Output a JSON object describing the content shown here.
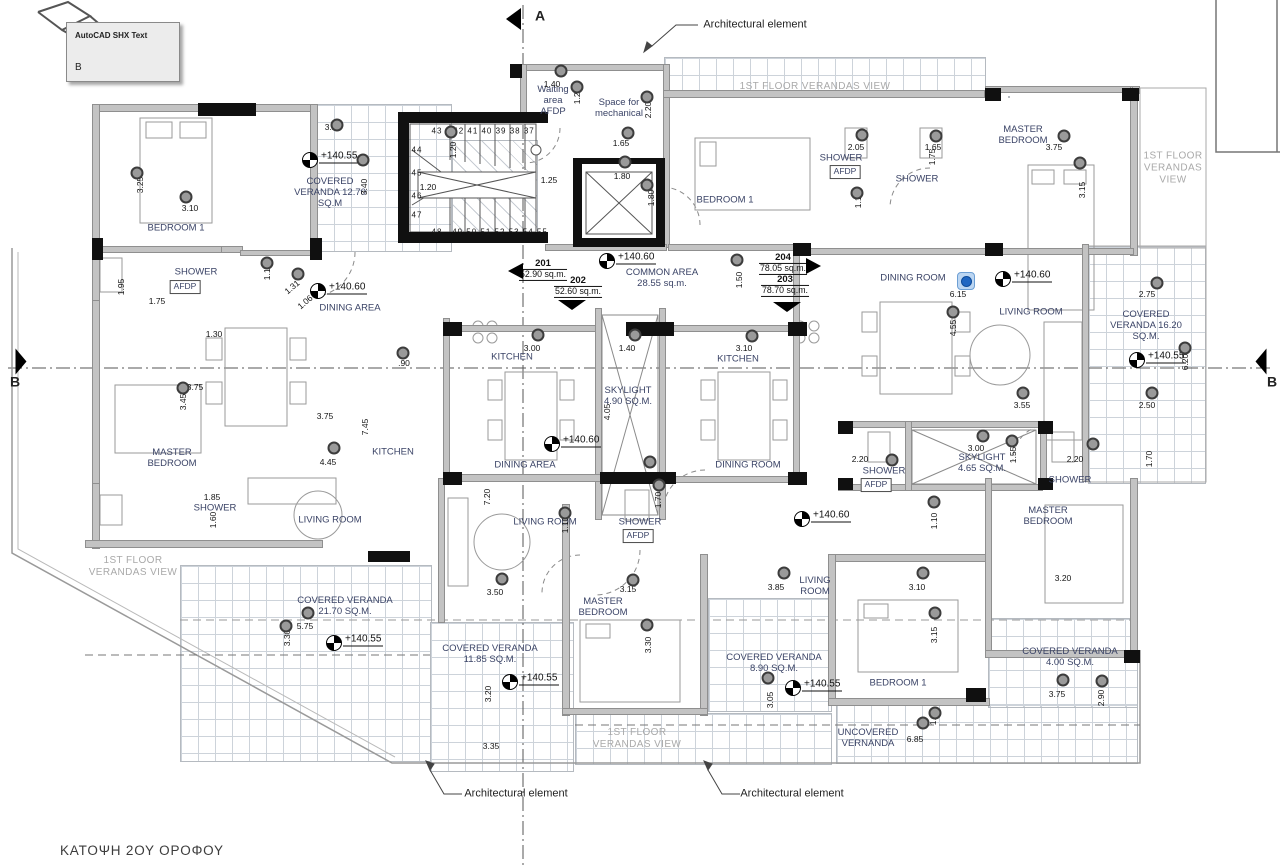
{
  "title": "ΚΑΤΟΨΗ 2ΟΥ ΟΡΟΦΟΥ",
  "tooltip": {
    "title": "AutoCAD SHX Text",
    "value": "B"
  },
  "section_markers": {
    "top": "A",
    "left": "B",
    "right": "B"
  },
  "arch_note_text": "Architectural element",
  "arch_notes": [
    {
      "x": 755,
      "y": 25
    },
    {
      "x": 516,
      "y": 794
    },
    {
      "x": 792,
      "y": 794
    }
  ],
  "units": [
    {
      "num": "201",
      "area": "52.90 sq.m.",
      "x": 543,
      "y": 270,
      "arrow": "left",
      "ax": 523,
      "ay": 271
    },
    {
      "num": "202",
      "area": "52.60 sq.m.",
      "x": 578,
      "y": 287,
      "arrow": "down",
      "ax": 572,
      "ay": 300
    },
    {
      "num": "204",
      "area": "78.05 sq.m.",
      "x": 783,
      "y": 264,
      "arrow": "right",
      "ax": 806,
      "ay": 266
    },
    {
      "num": "203",
      "area": "78.70 sq.m.",
      "x": 785,
      "y": 286,
      "arrow": "down",
      "ax": 787,
      "ay": 302
    }
  ],
  "common_area": {
    "name": "COMMON AREA",
    "area": "28.55 sq.m.",
    "x": 662,
    "y": 278
  },
  "levels": [
    {
      "v": "+140.55",
      "x": 310,
      "y": 160
    },
    {
      "v": "+140.60",
      "x": 318,
      "y": 291
    },
    {
      "v": "+140.60",
      "x": 607,
      "y": 261
    },
    {
      "v": "+140.60",
      "x": 1003,
      "y": 279
    },
    {
      "v": "+140.55",
      "x": 1137,
      "y": 360
    },
    {
      "v": "+140.60",
      "x": 552,
      "y": 444
    },
    {
      "v": "+140.60",
      "x": 802,
      "y": 519
    },
    {
      "v": "+140.55",
      "x": 334,
      "y": 643
    },
    {
      "v": "+140.55",
      "x": 510,
      "y": 682
    },
    {
      "v": "+140.55",
      "x": 793,
      "y": 688
    }
  ],
  "rooms": [
    {
      "t": "BEDROOM 1",
      "x": 176,
      "y": 228
    },
    {
      "t": "SHOWER",
      "x": 196,
      "y": 272
    },
    {
      "t": "COVERED\nVERANDA 12.70\nSQ.M",
      "x": 330,
      "y": 193
    },
    {
      "t": "DINING AREA",
      "x": 350,
      "y": 308
    },
    {
      "t": "Waiting\narea\nAFDP",
      "x": 553,
      "y": 101
    },
    {
      "t": "Space for\nmechanical",
      "x": 619,
      "y": 108
    },
    {
      "t": "BEDROOM 1",
      "x": 725,
      "y": 200
    },
    {
      "t": "SHOWER",
      "x": 841,
      "y": 158
    },
    {
      "t": "SHOWER",
      "x": 917,
      "y": 179
    },
    {
      "t": "MASTER\nBEDROOM",
      "x": 1023,
      "y": 135
    },
    {
      "t": "DINING ROOM",
      "x": 913,
      "y": 278
    },
    {
      "t": "LIVING ROOM",
      "x": 1031,
      "y": 312
    },
    {
      "t": "COVERED\nVERANDA 16.20\nSQ.M.",
      "x": 1146,
      "y": 326
    },
    {
      "t": "KITCHEN",
      "x": 512,
      "y": 357
    },
    {
      "t": "KITCHEN",
      "x": 738,
      "y": 359
    },
    {
      "t": "SKYLIGHT\n4.90 SQ.M.",
      "x": 628,
      "y": 396
    },
    {
      "t": "DINING AREA",
      "x": 525,
      "y": 465
    },
    {
      "t": "DINING ROOM",
      "x": 748,
      "y": 465
    },
    {
      "t": "MASTER\nBEDROOM",
      "x": 172,
      "y": 458
    },
    {
      "t": "KITCHEN",
      "x": 393,
      "y": 452
    },
    {
      "t": "SHOWER",
      "x": 215,
      "y": 508
    },
    {
      "t": "LIVING ROOM",
      "x": 330,
      "y": 520
    },
    {
      "t": "LIVING ROOM",
      "x": 545,
      "y": 522
    },
    {
      "t": "SHOWER",
      "x": 640,
      "y": 522
    },
    {
      "t": "SHOWER",
      "x": 884,
      "y": 471
    },
    {
      "t": "SKYLIGHT\n4.65 SQ.M.",
      "x": 982,
      "y": 463
    },
    {
      "t": "SHOWER",
      "x": 1070,
      "y": 480
    },
    {
      "t": "MASTER\nBEDROOM",
      "x": 1048,
      "y": 516
    },
    {
      "t": "MASTER\nBEDROOM",
      "x": 603,
      "y": 607
    },
    {
      "t": "COVERED VERANDA\n21.70 SQ.M.",
      "x": 345,
      "y": 606
    },
    {
      "t": "COVERED VERANDA\n11.85 SQ.M.",
      "x": 490,
      "y": 654
    },
    {
      "t": "LIVING\nROOM",
      "x": 815,
      "y": 586
    },
    {
      "t": "COVERED VERANDA\n8.90 SQ.M.",
      "x": 774,
      "y": 663
    },
    {
      "t": "BEDROOM 1",
      "x": 898,
      "y": 683
    },
    {
      "t": "UNCOVERED\nVERNANDA",
      "x": 868,
      "y": 738
    },
    {
      "t": "COVERED VERANDA\n4.00 SQ.M.",
      "x": 1070,
      "y": 657
    }
  ],
  "afdp_label": "AFDP",
  "afdp_boxes": [
    {
      "x": 845,
      "y": 172
    },
    {
      "x": 185,
      "y": 287
    },
    {
      "x": 876,
      "y": 485
    },
    {
      "x": 638,
      "y": 536
    }
  ],
  "gray_notes": [
    {
      "t": "1ST FLOOR VERANDAS VIEW",
      "x": 815,
      "y": 87
    },
    {
      "t": "1ST FLOOR\nVERANDAS\nVIEW",
      "x": 1173,
      "y": 168
    },
    {
      "t": "1ST FLOOR\nVERANDAS VIEW",
      "x": 133,
      "y": 567
    },
    {
      "t": "1ST FLOOR\nVERANDAS VIEW",
      "x": 637,
      "y": 739
    }
  ],
  "dims_h": [
    {
      "t": "1.40",
      "x": 552,
      "y": 84
    },
    {
      "t": "1.65",
      "x": 621,
      "y": 143
    },
    {
      "t": "1.25",
      "x": 549,
      "y": 180
    },
    {
      "t": "1.80",
      "x": 622,
      "y": 176
    },
    {
      "t": "1.20",
      "x": 428,
      "y": 187
    },
    {
      "t": "2.05",
      "x": 856,
      "y": 147
    },
    {
      "t": "1.65",
      "x": 933,
      "y": 147
    },
    {
      "t": "3.75",
      "x": 1054,
      "y": 147
    },
    {
      "t": "3.10",
      "x": 190,
      "y": 208
    },
    {
      "t": "1.75",
      "x": 157,
      "y": 301
    },
    {
      "t": "3.20",
      "x": 333,
      "y": 127
    },
    {
      "t": "6.15",
      "x": 958,
      "y": 294
    },
    {
      "t": "2.75",
      "x": 1147,
      "y": 294
    },
    {
      "t": "2.50",
      "x": 1147,
      "y": 405
    },
    {
      "t": "3.55",
      "x": 1022,
      "y": 405
    },
    {
      "t": "3.00",
      "x": 532,
      "y": 348
    },
    {
      "t": "1.40",
      "x": 627,
      "y": 348
    },
    {
      "t": "3.10",
      "x": 744,
      "y": 348
    },
    {
      "t": "1.30",
      "x": 214,
      "y": 334
    },
    {
      "t": ".90",
      "x": 404,
      "y": 363
    },
    {
      "t": "3.75",
      "x": 325,
      "y": 416
    },
    {
      "t": "4.45",
      "x": 328,
      "y": 462
    },
    {
      "t": "1.85",
      "x": 212,
      "y": 497
    },
    {
      "t": "3.75",
      "x": 195,
      "y": 387
    },
    {
      "t": "5.75",
      "x": 305,
      "y": 626
    },
    {
      "t": "3.50",
      "x": 495,
      "y": 592
    },
    {
      "t": "3.15",
      "x": 628,
      "y": 589
    },
    {
      "t": "3.35",
      "x": 491,
      "y": 746
    },
    {
      "t": "3.85",
      "x": 776,
      "y": 587
    },
    {
      "t": "3.10",
      "x": 917,
      "y": 587
    },
    {
      "t": "6.85",
      "x": 915,
      "y": 739
    },
    {
      "t": "3.75",
      "x": 1057,
      "y": 694
    },
    {
      "t": "3.20",
      "x": 1063,
      "y": 578
    },
    {
      "t": "2.20",
      "x": 860,
      "y": 459
    },
    {
      "t": "3.00",
      "x": 976,
      "y": 448
    },
    {
      "t": "2.20",
      "x": 1075,
      "y": 459
    }
  ],
  "dims_v": [
    {
      "t": "2.20",
      "x": 648,
      "y": 110
    },
    {
      "t": "1.20",
      "x": 577,
      "y": 96
    },
    {
      "t": "1.80",
      "x": 651,
      "y": 198
    },
    {
      "t": "1.20",
      "x": 453,
      "y": 150
    },
    {
      "t": "1.75",
      "x": 932,
      "y": 157
    },
    {
      "t": "1.10",
      "x": 858,
      "y": 200
    },
    {
      "t": "3.15",
      "x": 1082,
      "y": 190
    },
    {
      "t": "3.25",
      "x": 140,
      "y": 185
    },
    {
      "t": "3.40",
      "x": 364,
      "y": 187
    },
    {
      "t": "1.95",
      "x": 121,
      "y": 287
    },
    {
      "t": "1.10",
      "x": 267,
      "y": 272
    },
    {
      "t": "1.50",
      "x": 739,
      "y": 280
    },
    {
      "t": "4.55",
      "x": 953,
      "y": 328
    },
    {
      "t": "6.20",
      "x": 1185,
      "y": 362
    },
    {
      "t": "4.05",
      "x": 607,
      "y": 412
    },
    {
      "t": "3.45",
      "x": 183,
      "y": 402
    },
    {
      "t": "7.45",
      "x": 365,
      "y": 427
    },
    {
      "t": "1.60",
      "x": 213,
      "y": 520
    },
    {
      "t": "3.30",
      "x": 287,
      "y": 638
    },
    {
      "t": "7.20",
      "x": 487,
      "y": 497
    },
    {
      "t": "1.10",
      "x": 565,
      "y": 525
    },
    {
      "t": "1.70",
      "x": 658,
      "y": 500
    },
    {
      "t": "3.30",
      "x": 648,
      "y": 645
    },
    {
      "t": "3.20",
      "x": 488,
      "y": 694
    },
    {
      "t": "3.15",
      "x": 934,
      "y": 635
    },
    {
      "t": "3.05",
      "x": 770,
      "y": 700
    },
    {
      "t": "1.30",
      "x": 933,
      "y": 717
    },
    {
      "t": "2.90",
      "x": 1101,
      "y": 698
    },
    {
      "t": "1.55",
      "x": 1013,
      "y": 455
    },
    {
      "t": "1.70",
      "x": 1149,
      "y": 459
    },
    {
      "t": "1.10",
      "x": 934,
      "y": 521
    }
  ],
  "dims_diag": [
    {
      "t": "1.31",
      "x": 292,
      "y": 287
    },
    {
      "t": "1.06",
      "x": 305,
      "y": 302
    }
  ],
  "stair_numbers": [
    {
      "t": "43",
      "x": 437,
      "y": 131
    },
    {
      "t": "42 41 40 39 38 37",
      "x": 494,
      "y": 131
    },
    {
      "t": "44",
      "x": 417,
      "y": 150
    },
    {
      "t": "45",
      "x": 417,
      "y": 173
    },
    {
      "t": "46",
      "x": 417,
      "y": 196
    },
    {
      "t": "47",
      "x": 417,
      "y": 215
    },
    {
      "t": "48",
      "x": 437,
      "y": 232
    },
    {
      "t": "49 50 51 52 53 54 55",
      "x": 500,
      "y": 232
    }
  ],
  "dots": [
    [
      451,
      132
    ],
    [
      561,
      71
    ],
    [
      577,
      87
    ],
    [
      647,
      97
    ],
    [
      628,
      133
    ],
    [
      625,
      162
    ],
    [
      647,
      185
    ],
    [
      862,
      135
    ],
    [
      936,
      136
    ],
    [
      1064,
      136
    ],
    [
      1080,
      163
    ],
    [
      857,
      193
    ],
    [
      137,
      173
    ],
    [
      186,
      197
    ],
    [
      337,
      125
    ],
    [
      363,
      160
    ],
    [
      298,
      274
    ],
    [
      267,
      263
    ],
    [
      737,
      260
    ],
    [
      953,
      312
    ],
    [
      1157,
      283
    ],
    [
      1185,
      348
    ],
    [
      1152,
      393
    ],
    [
      1023,
      393
    ],
    [
      538,
      335
    ],
    [
      635,
      335
    ],
    [
      752,
      336
    ],
    [
      403,
      353
    ],
    [
      183,
      388
    ],
    [
      334,
      448
    ],
    [
      565,
      513
    ],
    [
      502,
      579
    ],
    [
      633,
      580
    ],
    [
      659,
      485
    ],
    [
      983,
      436
    ],
    [
      1012,
      441
    ],
    [
      1093,
      444
    ],
    [
      892,
      460
    ],
    [
      934,
      502
    ],
    [
      286,
      626
    ],
    [
      308,
      613
    ],
    [
      647,
      625
    ],
    [
      784,
      573
    ],
    [
      923,
      573
    ],
    [
      935,
      613
    ],
    [
      768,
      678
    ],
    [
      935,
      713
    ],
    [
      1063,
      680
    ],
    [
      1102,
      681
    ],
    [
      923,
      723
    ],
    [
      650,
      462
    ]
  ],
  "blue_grip": {
    "x": 966,
    "y": 281
  }
}
